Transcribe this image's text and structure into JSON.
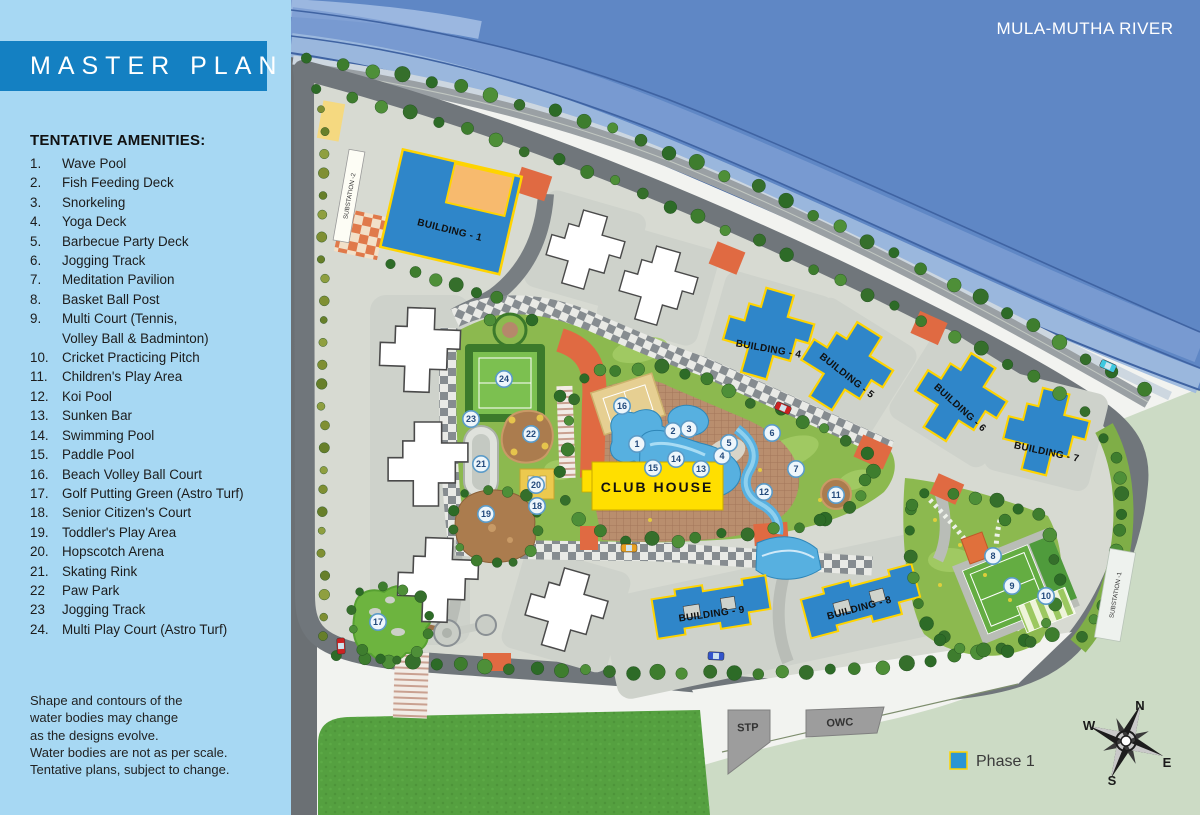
{
  "sidebar": {
    "title": "MASTER PLAN",
    "amenities_heading": "TENTATIVE AMENITIES:",
    "amenities": [
      {
        "num": "1.",
        "label": "Wave Pool"
      },
      {
        "num": "2.",
        "label": "Fish Feeding Deck"
      },
      {
        "num": "3.",
        "label": "Snorkeling"
      },
      {
        "num": "4.",
        "label": "Yoga Deck"
      },
      {
        "num": "5.",
        "label": "Barbecue Party Deck"
      },
      {
        "num": "6.",
        "label": "Jogging Track"
      },
      {
        "num": "7.",
        "label": "Meditation Pavilion"
      },
      {
        "num": "8.",
        "label": "Basket Ball Post"
      },
      {
        "num": "9.",
        "label": "Multi Court (Tennis,\nVolley Ball & Badminton)"
      },
      {
        "num": "10.",
        "label": "Cricket Practicing Pitch"
      },
      {
        "num": "11.",
        "label": "Children's Play Area"
      },
      {
        "num": "12.",
        "label": "Koi Pool"
      },
      {
        "num": "13.",
        "label": "Sunken Bar"
      },
      {
        "num": "14.",
        "label": "Swimming Pool"
      },
      {
        "num": "15.",
        "label": "Paddle Pool"
      },
      {
        "num": "16.",
        "label": "Beach Volley Ball Court"
      },
      {
        "num": "17.",
        "label": "Golf Putting Green (Astro Turf)"
      },
      {
        "num": "18.",
        "label": "Senior Citizen's Court"
      },
      {
        "num": "19.",
        "label": "Toddler's Play Area"
      },
      {
        "num": "20.",
        "label": "Hopscotch Arena"
      },
      {
        "num": "21.",
        "label": "Skating Rink"
      },
      {
        "num": "22",
        "label": "Paw Park"
      },
      {
        "num": "23",
        "label": "Jogging Track"
      },
      {
        "num": "24.",
        "label": "Multi Play Court (Astro Turf)"
      }
    ],
    "disclaimer_lines": [
      "Shape and contours of the",
      "water bodies may change",
      "as the designs evolve.",
      "Water bodies are not as per scale.",
      "Tentative plans, subject to change."
    ]
  },
  "map": {
    "river_label": "MULA-MUTHA RIVER",
    "clubhouse_label": "CLUB HOUSE",
    "stp_label": "STP",
    "owc_label": "OWC",
    "substation1_label": "SUBSTATION -1",
    "substation2_label": "SUBSTATION -2",
    "legend": {
      "phase1_label": "Phase 1",
      "phase1_color": "#2b95d4"
    },
    "compass": {
      "n": "N",
      "e": "E",
      "s": "S",
      "w": "W"
    },
    "buildings": {
      "b1": "BUILDING - 1",
      "b4": "BUILDING - 4",
      "b5": "BUILDING - 5",
      "b6": "BUILDING - 6",
      "b7": "BUILDING - 7",
      "b8": "BUILDING - 8",
      "b9": "BUILDING - 9"
    },
    "markers": [
      {
        "n": "1",
        "x": 637,
        "y": 444
      },
      {
        "n": "2",
        "x": 673,
        "y": 431
      },
      {
        "n": "3",
        "x": 689,
        "y": 429
      },
      {
        "n": "4",
        "x": 722,
        "y": 456
      },
      {
        "n": "5",
        "x": 729,
        "y": 443
      },
      {
        "n": "6",
        "x": 772,
        "y": 433
      },
      {
        "n": "7",
        "x": 796,
        "y": 469
      },
      {
        "n": "8",
        "x": 993,
        "y": 556
      },
      {
        "n": "9",
        "x": 1012,
        "y": 586
      },
      {
        "n": "10",
        "x": 1046,
        "y": 596
      },
      {
        "n": "11",
        "x": 836,
        "y": 495
      },
      {
        "n": "12",
        "x": 764,
        "y": 492
      },
      {
        "n": "13",
        "x": 701,
        "y": 469
      },
      {
        "n": "14",
        "x": 676,
        "y": 459
      },
      {
        "n": "15",
        "x": 653,
        "y": 468
      },
      {
        "n": "16",
        "x": 622,
        "y": 406
      },
      {
        "n": "17",
        "x": 378,
        "y": 622
      },
      {
        "n": "18",
        "x": 537,
        "y": 506
      },
      {
        "n": "19",
        "x": 486,
        "y": 514
      },
      {
        "n": "20",
        "x": 536,
        "y": 485
      },
      {
        "n": "21",
        "x": 481,
        "y": 464
      },
      {
        "n": "22",
        "x": 531,
        "y": 434
      },
      {
        "n": "23",
        "x": 471,
        "y": 419
      },
      {
        "n": "24",
        "x": 504,
        "y": 379
      }
    ]
  },
  "colors": {
    "sidebar_bg": "#a7d8f3",
    "title_bg": "#1480c2",
    "building_blue": "#2f86c9",
    "outline_yellow": "#ffd400",
    "clubhouse_yellow": "#ffdf00",
    "river_blue": "#5f87c5",
    "phase1_blue": "#2b95d4"
  }
}
